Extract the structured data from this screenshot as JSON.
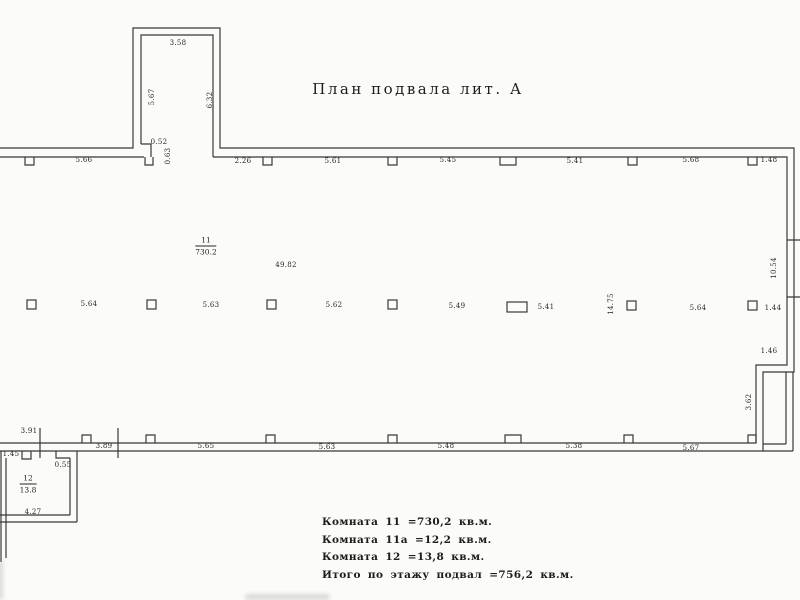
{
  "title": "План подвала лит. А",
  "rooms": [
    {
      "number": "11",
      "area": "730.2"
    },
    {
      "number": "12",
      "area": "13.8"
    }
  ],
  "legend": {
    "lines": [
      "Комната 11 =730,2 кв.м.",
      "Комната 11а =12,2 кв.м.",
      "Комната 12 =13,8 кв.м.",
      "Итого по этажу подвал =756,2 кв.м."
    ]
  },
  "plan": {
    "dimensions": [
      {
        "t": "5.66",
        "x": 84,
        "y": 160
      },
      {
        "t": "2.26",
        "x": 243,
        "y": 161
      },
      {
        "t": "5.61",
        "x": 333,
        "y": 161
      },
      {
        "t": "5.45",
        "x": 448,
        "y": 160
      },
      {
        "t": "5.41",
        "x": 575,
        "y": 161
      },
      {
        "t": "5.68",
        "x": 691,
        "y": 160
      },
      {
        "t": "1.48",
        "x": 769,
        "y": 160
      },
      {
        "t": "3.58",
        "x": 178,
        "y": 43
      },
      {
        "t": "5.67",
        "x": 152,
        "y": 97,
        "r": -90
      },
      {
        "t": "6.32",
        "x": 210,
        "y": 100,
        "r": -90
      },
      {
        "t": "0.52",
        "x": 159,
        "y": 142
      },
      {
        "t": "0.63",
        "x": 168,
        "y": 156,
        "r": -90
      },
      {
        "t": "49.82",
        "x": 286,
        "y": 265
      },
      {
        "t": "5.64",
        "x": 89,
        "y": 304
      },
      {
        "t": "5.63",
        "x": 211,
        "y": 305
      },
      {
        "t": "5.62",
        "x": 334,
        "y": 305
      },
      {
        "t": "5.49",
        "x": 457,
        "y": 306
      },
      {
        "t": "5.41",
        "x": 546,
        "y": 307
      },
      {
        "t": "14.75",
        "x": 611,
        "y": 304,
        "r": -90
      },
      {
        "t": "5.64",
        "x": 698,
        "y": 308
      },
      {
        "t": "1.44",
        "x": 773,
        "y": 308
      },
      {
        "t": "10.54",
        "x": 774,
        "y": 268,
        "r": -90
      },
      {
        "t": "1.46",
        "x": 769,
        "y": 351
      },
      {
        "t": "3.62",
        "x": 749,
        "y": 402,
        "r": -90
      },
      {
        "t": "3.91",
        "x": 29,
        "y": 431
      },
      {
        "t": "1.45",
        "x": 11,
        "y": 454
      },
      {
        "t": "0.55",
        "x": 63,
        "y": 465
      },
      {
        "t": "3.89",
        "x": 104,
        "y": 446
      },
      {
        "t": "5.65",
        "x": 206,
        "y": 446
      },
      {
        "t": "5.63",
        "x": 327,
        "y": 447
      },
      {
        "t": "5.48",
        "x": 446,
        "y": 446
      },
      {
        "t": "5.38",
        "x": 574,
        "y": 446
      },
      {
        "t": "5.67",
        "x": 691,
        "y": 448
      },
      {
        "t": "4.27",
        "x": 33,
        "y": 512
      }
    ],
    "columns": [
      {
        "x": 27,
        "y": 300,
        "w": 9,
        "h": 9
      },
      {
        "x": 147,
        "y": 300,
        "w": 9,
        "h": 9
      },
      {
        "x": 267,
        "y": 300,
        "w": 9,
        "h": 9
      },
      {
        "x": 388,
        "y": 300,
        "w": 9,
        "h": 9
      },
      {
        "x": 507,
        "y": 302,
        "w": 20,
        "h": 10
      },
      {
        "x": 627,
        "y": 301,
        "w": 9,
        "h": 9
      },
      {
        "x": 748,
        "y": 301,
        "w": 9,
        "h": 9
      }
    ]
  },
  "colors": {
    "ink": "#383838",
    "text": "#262626",
    "paper": "#fbfbf9"
  }
}
